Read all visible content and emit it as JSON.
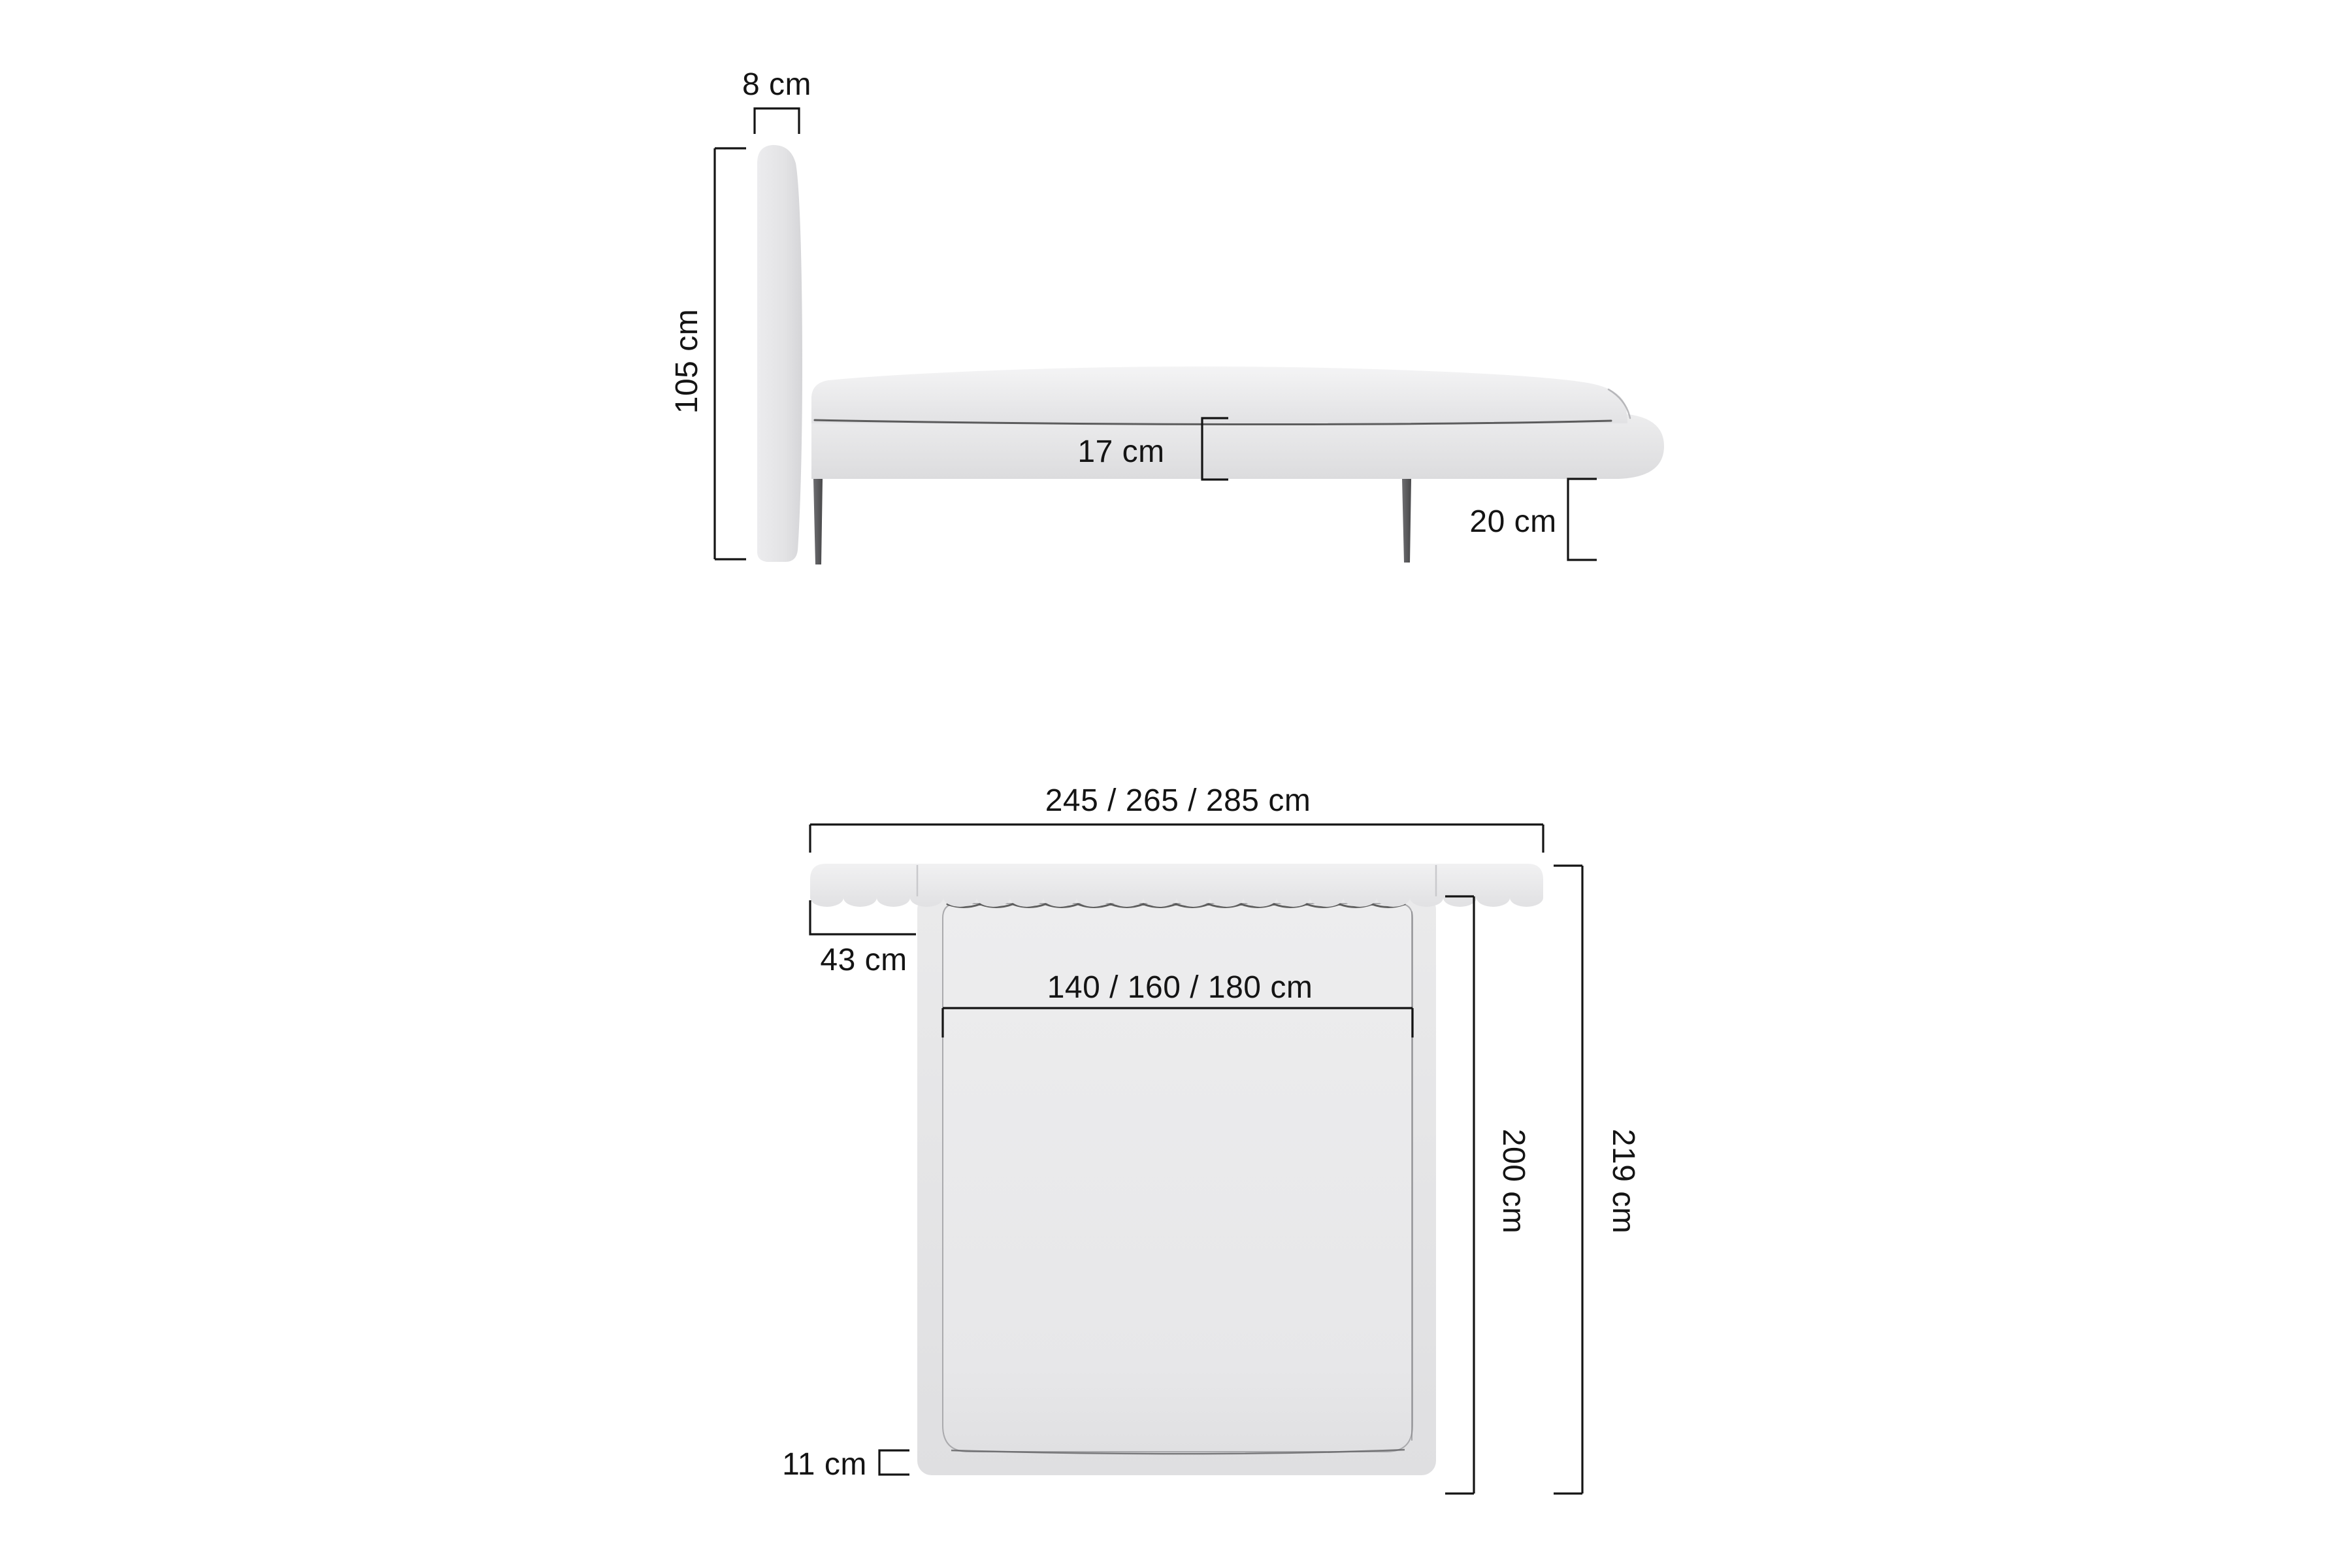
{
  "side_view": {
    "headboard_thickness_label": "8 cm",
    "headboard_height_label": "105 cm",
    "frame_height_label": "17 cm",
    "leg_height_label": "20 cm"
  },
  "top_view": {
    "total_width_label": "245 / 265 / 285 cm",
    "headboard_overhang_label": "43 cm",
    "mattress_width_label": "140 / 160 / 180 cm",
    "mattress_length_label": "200 cm",
    "total_length_label": "219 cm",
    "frame_border_label": "11 cm"
  },
  "dimensions_cm": {
    "headboard_thickness": 8,
    "headboard_height": 105,
    "frame_height": 17,
    "leg_height": 20,
    "total_widths": [
      245,
      265,
      285
    ],
    "headboard_overhang": 43,
    "mattress_widths": [
      140,
      160,
      180
    ],
    "mattress_length": 200,
    "total_length": 219,
    "frame_border": 11
  },
  "colors": {
    "background": "#ffffff",
    "dimension_lines": "#141414",
    "label_text": "#141414",
    "upholstery_light": "#f2f2f3",
    "upholstery_mid": "#e6e6e8",
    "upholstery_dark": "#d6d6d9",
    "leg_dark": "#4a4a4c",
    "seam": "#3a3a3a"
  }
}
